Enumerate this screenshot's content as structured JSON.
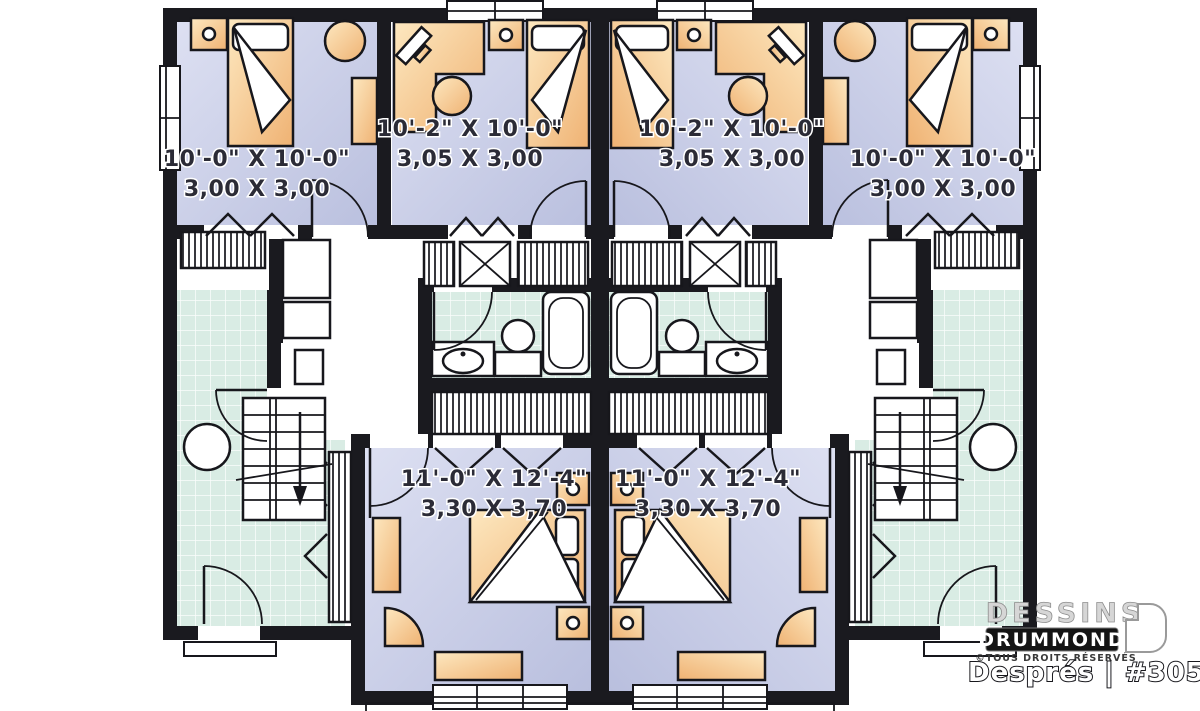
{
  "title": "Semi-detached basement floor plan",
  "plan": {
    "units": {
      "left": {
        "bedroom_small": {
          "imperial": "10'-0\" X 10'-0\"",
          "metric": "3,00 X 3,00"
        },
        "bedroom_mid": {
          "imperial": "10'-2\" X 10'-0\"",
          "metric": "3,05 X 3,00"
        },
        "bedroom_master": {
          "imperial": "11'-0\" X 12'-4\"",
          "metric": "3,30 X 3,70"
        }
      },
      "right": {
        "bedroom_small": {
          "imperial": "10'-0\" X 10'-0\"",
          "metric": "3,00 X 3,00"
        },
        "bedroom_mid": {
          "imperial": "10'-2\" X 10'-0\"",
          "metric": "3,05 X 3,00"
        },
        "bedroom_master": {
          "imperial": "11'-0\" X 12'-4\"",
          "metric": "3,30 X 3,70"
        }
      }
    }
  },
  "branding": {
    "brand_line1": "DESSINS",
    "brand_line2": "DRUMMOND",
    "rights": "©TOUS DROITS RÉSERVÉS",
    "model": "Després | #3051"
  },
  "colors": {
    "wall": "#1a1a1f",
    "bedroom_floor": "#c8cde6",
    "furniture_wood": "#f5c98c",
    "tile_floor": "#d9ece4",
    "background": "#ffffff",
    "label_text": "#2b2b36"
  }
}
